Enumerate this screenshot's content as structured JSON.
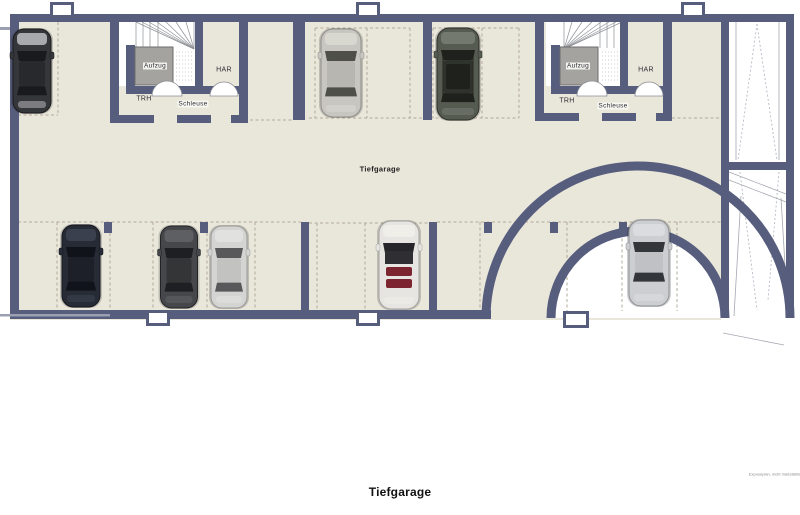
{
  "title": "Tiefgarage",
  "zones": {
    "area_label": "Tiefgarage",
    "left_core": {
      "elevator": "Aufzug",
      "stairs": "TRH",
      "airlock": "Schleuse",
      "utility": "HAR"
    },
    "right_core": {
      "elevator": "Aufzug",
      "stairs": "TRH",
      "airlock": "Schleuse",
      "utility": "HAR"
    }
  },
  "footnote": "Exposéplan, nicht maßstäblich",
  "colors": {
    "wall": "#575d7d",
    "floor": "#e9e6da",
    "dash": "#b2ab99",
    "shaft": "#a4a3a0"
  },
  "cars": [
    {
      "name": "car-black-sedan-top-left",
      "cx": 32,
      "cy": 71,
      "w": 38,
      "h": 84,
      "kind": "sedan",
      "body": "#35363a",
      "edge": "#1a1a1d",
      "hood": "#b6b7ba",
      "glass": "#191a1e",
      "roof": "#28292d"
    },
    {
      "name": "car-silver-sedan-top-middle",
      "cx": 341,
      "cy": 73,
      "w": 40,
      "h": 88,
      "kind": "sedan",
      "body": "#c7c6c0",
      "edge": "#8f8e88",
      "hood": "#d9d8d2",
      "glass": "#4e4f48",
      "roof": "#b7b6b0"
    },
    {
      "name": "car-dark-suv-top-middle",
      "cx": 458,
      "cy": 74,
      "w": 42,
      "h": 92,
      "kind": "suv",
      "body": "#565b52",
      "edge": "#2b2e28",
      "hood": "#777c72",
      "glass": "#1f221c",
      "roof": "#2e332c"
    },
    {
      "name": "car-dark-blue-sedan-bottom",
      "cx": 81,
      "cy": 266,
      "w": 38,
      "h": 82,
      "kind": "sedan",
      "body": "#272b36",
      "edge": "#14161d",
      "hood": "#3d4350",
      "glass": "#10131a",
      "roof": "#1d2029"
    },
    {
      "name": "car-gray-sedan-bottom",
      "cx": 179,
      "cy": 267,
      "w": 37,
      "h": 82,
      "kind": "sedan",
      "body": "#45474a",
      "edge": "#232426",
      "hood": "#606266",
      "glass": "#1e1f22",
      "roof": "#333537"
    },
    {
      "name": "car-silver-sedan-bottom",
      "cx": 229,
      "cy": 267,
      "w": 36,
      "h": 82,
      "kind": "sedan",
      "body": "#d4d4d2",
      "edge": "#9a9a98",
      "hood": "#e2e2e0",
      "glass": "#58585a",
      "roof": "#c2c2c0"
    },
    {
      "name": "car-white-convertible-bottom",
      "cx": 399,
      "cy": 265,
      "w": 40,
      "h": 88,
      "kind": "convertible",
      "body": "#e6e5e1",
      "edge": "#a5a49f",
      "hood": "#efeeea",
      "glass": "#26262a",
      "roof": "#2f2f33",
      "accent": "#7c2430"
    },
    {
      "name": "car-silver-sports-bottom-right",
      "cx": 649,
      "cy": 263,
      "w": 40,
      "h": 86,
      "kind": "sports",
      "body": "#ccced1",
      "edge": "#8e9094",
      "hood": "#dcdee1",
      "glass": "#33363b",
      "roof": "#bfc1c4"
    }
  ]
}
